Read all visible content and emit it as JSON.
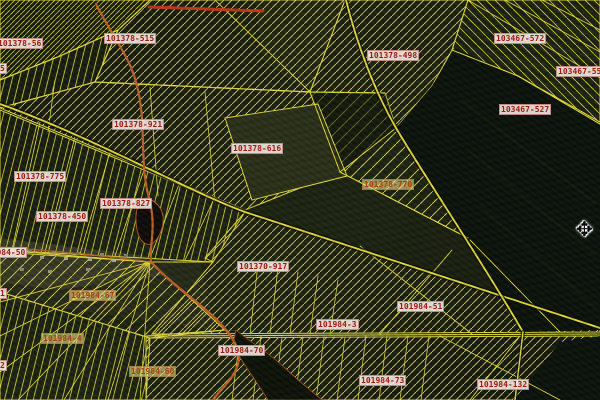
{
  "map": {
    "labels": [
      {
        "text": "101378-56",
        "x": -4,
        "y": 38,
        "variant": "box"
      },
      {
        "text": "101378-515",
        "x": 104,
        "y": 33,
        "variant": "box"
      },
      {
        "text": "101378-498",
        "x": 367,
        "y": 50,
        "variant": "box"
      },
      {
        "text": "103467-572",
        "x": 494,
        "y": 33,
        "variant": "box"
      },
      {
        "text": "103467-55",
        "x": 556,
        "y": 66,
        "variant": "box"
      },
      {
        "text": "103467-527",
        "x": 499,
        "y": 104,
        "variant": "box"
      },
      {
        "text": "101378-921",
        "x": 112,
        "y": 119,
        "variant": "box"
      },
      {
        "text": "101378-616",
        "x": 231,
        "y": 143,
        "variant": "box"
      },
      {
        "text": "101378-775",
        "x": 14,
        "y": 171,
        "variant": "box"
      },
      {
        "text": "101378-770",
        "x": 362,
        "y": 179,
        "variant": "yellow"
      },
      {
        "text": "101378-827",
        "x": 100,
        "y": 198,
        "variant": "box"
      },
      {
        "text": "101378-450",
        "x": 36,
        "y": 211,
        "variant": "box"
      },
      {
        "text": "101984-50",
        "x": -20,
        "y": 247,
        "variant": "box"
      },
      {
        "text": "101370-917",
        "x": 237,
        "y": 261,
        "variant": "box"
      },
      {
        "text": "101984-67",
        "x": 69,
        "y": 290,
        "variant": "yellow"
      },
      {
        "text": "101984-51",
        "x": 397,
        "y": 301,
        "variant": "box"
      },
      {
        "text": "101984-3",
        "x": 316,
        "y": 319,
        "variant": "box"
      },
      {
        "text": "101984-4",
        "x": 41,
        "y": 333,
        "variant": "yellow"
      },
      {
        "text": "101984-70",
        "x": 218,
        "y": 345,
        "variant": "box"
      },
      {
        "text": "101984-60",
        "x": 129,
        "y": 366,
        "variant": "yellow"
      },
      {
        "text": "101984-73",
        "x": 359,
        "y": 375,
        "variant": "box"
      },
      {
        "text": "101984-132",
        "x": 477,
        "y": 379,
        "variant": "box"
      },
      {
        "text": "5",
        "x": -2,
        "y": 63,
        "variant": "box"
      },
      {
        "text": "1",
        "x": -2,
        "y": 288,
        "variant": "box"
      },
      {
        "text": "2",
        "x": -2,
        "y": 360,
        "variant": "box"
      }
    ],
    "cursor": {
      "glyph": "✥",
      "x": 576,
      "y": 219
    },
    "colors": {
      "line": "#e4dc3c",
      "orange": "#c06428",
      "red": "#c23a10",
      "forest": "#0a120a",
      "base1": "#141a0e",
      "base2": "#1d2412",
      "label_text": "#9e1b10",
      "label_bg": "rgba(248,236,232,0.88)",
      "label_text2": "#a8430e",
      "label_bg2": "rgba(232,216,138,0.62)"
    }
  }
}
